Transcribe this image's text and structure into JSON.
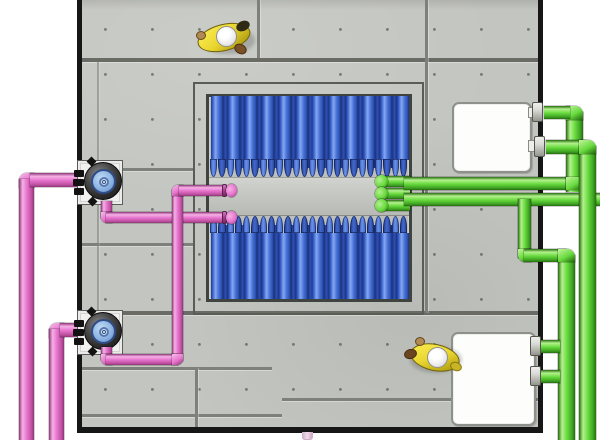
{
  "scene": {
    "kind": "3d-plan-view-illustration",
    "subject": "membrane-tank-with-pumps-and-piping"
  },
  "colors": {
    "background": "#ffffff",
    "concrete": "#c3c5c0",
    "concrete_seam": "#7e807b",
    "concrete_seam_strong": "#696b64",
    "wall": "#161616",
    "inner_outline": "#5a5c56",
    "frame_border": "#3f4440",
    "frame_fill": "#bdbfba",
    "manifold": "#c6c8c3",
    "tube_blue_main": "#4a74d8",
    "tube_blue_highlight": "#86a8f0",
    "tube_blue_dark": "#1e3c96",
    "tube_blue_back": "#2f51b4",
    "cap_blue_light": "#6b92ea",
    "cap_blue_dark": "#4568cc",
    "pink_highlight": "#f6b1e6",
    "pink_main": "#e673cd",
    "pink_shade": "#bd4f9e",
    "pink_dark": "#8d3577",
    "green_highlight": "#b4f18e",
    "green_main": "#67da3d",
    "green_shade": "#3da022",
    "green_dark": "#256c0e",
    "pump_ring": "#2c2c2c",
    "pump_disc": "#8ab2e2",
    "pump_disc_light": "#c2dcf4",
    "pump_plate": "#f1f1ef",
    "box_fill": "#fdfdfc",
    "box_border": "#8e908c",
    "helmet": "#ffffff",
    "jacket_yellow": "#e9d52f",
    "flange_gray": "#d8d8d4",
    "pale_pipe": "#f0dcea"
  },
  "cassette": {
    "banks": 2,
    "wide_tubes_per_bank": 12,
    "narrow_tubes_per_bank": 11,
    "caps_per_row": 24
  },
  "equipment": {
    "pumps": [
      {
        "id": "pump-1"
      },
      {
        "id": "pump-2"
      }
    ],
    "equipment_boxes": [
      {
        "id": "equipment-box-top"
      },
      {
        "id": "equipment-box-bottom"
      }
    ],
    "workers": [
      {
        "id": "worker-top"
      },
      {
        "id": "worker-bottom"
      }
    ],
    "piping": {
      "pink_system": "pump-suction-discharge-lines",
      "green_system": "permeate-air-lines"
    }
  }
}
